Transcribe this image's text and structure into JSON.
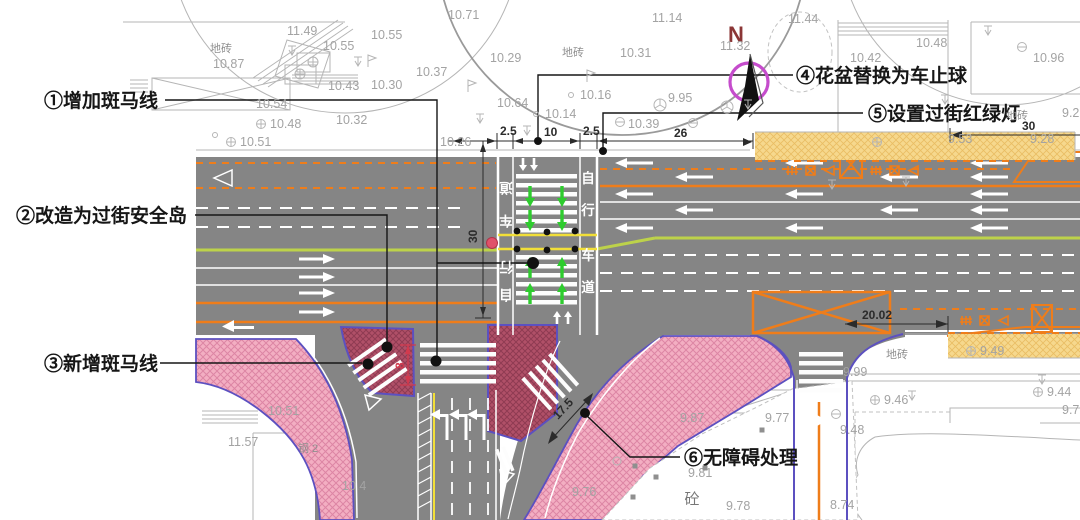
{
  "annotations": {
    "a1": {
      "label": "①增加斑马线"
    },
    "a2": {
      "label": "②改造为过街安全岛"
    },
    "a3": {
      "label": "③新增斑马线"
    },
    "a4": {
      "label": "④花盆替换为车止球"
    },
    "a5": {
      "label": "⑤设置过街红绿灯"
    },
    "a6": {
      "label": "⑥无障碍处理"
    }
  },
  "compass": {
    "north": "N"
  },
  "dimensions": {
    "bike_w_left": "2.5",
    "crossing_w": "10",
    "bike_w_right": "2.5",
    "road_e": "26",
    "road_ne": "30",
    "crossing_len": "30",
    "gap": "20.02",
    "slip_cross": "17.5",
    "south_cross": "8"
  },
  "bike_lane_text": "自行车道",
  "lane_labels": {
    "bike_left": [
      "道",
      "车",
      "行",
      "自"
    ],
    "bike_right": [
      "自",
      "行",
      "车",
      "道"
    ]
  },
  "surface_labels": {
    "paving": "地砖",
    "concrete": "砼",
    "steel": "钢 2"
  },
  "elevations": [
    {
      "v": "11.49",
      "x": 287,
      "y": 35
    },
    {
      "v": "10.55",
      "x": 323,
      "y": 50
    },
    {
      "v": "10.55",
      "x": 371,
      "y": 39
    },
    {
      "v": "10.87",
      "x": 213,
      "y": 68
    },
    {
      "v": "10.54",
      "x": 256,
      "y": 108
    },
    {
      "v": "10.48",
      "x": 270,
      "y": 128,
      "m": "oplus"
    },
    {
      "v": "10.51",
      "x": 240,
      "y": 146,
      "m": "oplus"
    },
    {
      "v": "10.43",
      "x": 328,
      "y": 90
    },
    {
      "v": "10.30",
      "x": 371,
      "y": 89
    },
    {
      "v": "10.32",
      "x": 336,
      "y": 124
    },
    {
      "v": "10.37",
      "x": 416,
      "y": 76
    },
    {
      "v": "10.71",
      "x": 448,
      "y": 19
    },
    {
      "v": "10.29",
      "x": 490,
      "y": 62
    },
    {
      "v": "10.64",
      "x": 497,
      "y": 107
    },
    {
      "v": "10.14",
      "x": 545,
      "y": 118,
      "m": "circ"
    },
    {
      "v": "10.16",
      "x": 580,
      "y": 99,
      "m": "circ"
    },
    {
      "v": "9.95",
      "x": 668,
      "y": 102
    },
    {
      "v": "10.39",
      "x": 628,
      "y": 128
    },
    {
      "v": "10.31",
      "x": 620,
      "y": 57
    },
    {
      "v": "11.14",
      "x": 652,
      "y": 22
    },
    {
      "v": "10.26",
      "x": 440,
      "y": 146
    },
    {
      "v": "11.32",
      "x": 720,
      "y": 50
    },
    {
      "v": "11.44",
      "x": 788,
      "y": 23
    },
    {
      "v": "10.42",
      "x": 850,
      "y": 62
    },
    {
      "v": "10.48",
      "x": 916,
      "y": 47
    },
    {
      "v": "10.96",
      "x": 1033,
      "y": 62
    },
    {
      "v": "9.53",
      "x": 948,
      "y": 143
    },
    {
      "v": "9.28",
      "x": 1030,
      "y": 143
    },
    {
      "v": "9.2",
      "x": 1062,
      "y": 117
    },
    {
      "v": "10.51",
      "x": 268,
      "y": 415
    },
    {
      "v": "11.57",
      "x": 228,
      "y": 446
    },
    {
      "v": "10.4",
      "x": 342,
      "y": 490
    },
    {
      "v": "9.99",
      "x": 843,
      "y": 376
    },
    {
      "v": "9.49",
      "x": 980,
      "y": 355,
      "m": "oplus"
    },
    {
      "v": "9.46",
      "x": 884,
      "y": 404,
      "m": "oplus"
    },
    {
      "v": "9.44",
      "x": 1047,
      "y": 396,
      "m": "oplus"
    },
    {
      "v": "9.7",
      "x": 1062,
      "y": 414
    },
    {
      "v": "9.87",
      "x": 680,
      "y": 422
    },
    {
      "v": "9.77",
      "x": 765,
      "y": 422
    },
    {
      "v": "9.48",
      "x": 840,
      "y": 434
    },
    {
      "v": "9.81",
      "x": 688,
      "y": 477
    },
    {
      "v": "9.76",
      "x": 572,
      "y": 496
    },
    {
      "v": "9.78",
      "x": 726,
      "y": 510
    },
    {
      "v": "8.74",
      "x": 830,
      "y": 509
    }
  ],
  "symbols": [
    {
      "t": "tick",
      "x": 292,
      "y": 46
    },
    {
      "t": "tick",
      "x": 358,
      "y": 57
    },
    {
      "t": "tick",
      "x": 480,
      "y": 114
    },
    {
      "t": "tick",
      "x": 527,
      "y": 126
    },
    {
      "t": "tick",
      "x": 748,
      "y": 100
    },
    {
      "t": "tick",
      "x": 832,
      "y": 180
    },
    {
      "t": "tick",
      "x": 945,
      "y": 95
    },
    {
      "t": "tick",
      "x": 988,
      "y": 26
    },
    {
      "t": "tick",
      "x": 906,
      "y": 177
    },
    {
      "t": "tick",
      "x": 912,
      "y": 391
    },
    {
      "t": "tick",
      "x": 1042,
      "y": 375
    },
    {
      "t": "oplus",
      "x": 877,
      "y": 142
    },
    {
      "t": "ominus",
      "x": 620,
      "y": 122
    },
    {
      "t": "ominus",
      "x": 693,
      "y": 123
    },
    {
      "t": "ominus",
      "x": 1022,
      "y": 47
    },
    {
      "t": "ominus",
      "x": 836,
      "y": 414
    },
    {
      "t": "tree",
      "x": 660,
      "y": 105
    },
    {
      "t": "tree",
      "x": 727,
      "y": 107
    },
    {
      "t": "flag",
      "x": 368,
      "y": 55
    },
    {
      "t": "flag",
      "x": 587,
      "y": 70
    },
    {
      "t": "flag",
      "x": 468,
      "y": 80
    },
    {
      "t": "circ",
      "x": 215,
      "y": 135
    }
  ],
  "plot_squares": [
    [
      635,
      466
    ],
    [
      656,
      477
    ],
    [
      633,
      497
    ],
    [
      705,
      468
    ],
    [
      762,
      430
    ]
  ],
  "colors": {
    "road": "#858585",
    "orange": "#ef7d1a",
    "chartreuse": "#bdd24a",
    "yellow": "#f2df38",
    "green": "#2ecc2e",
    "pink_bg": "#f3aec2",
    "pink_hatch": "#dd85a4",
    "maroon_bg": "#b05068",
    "maroon_hatch": "#8f3b52",
    "curb": "#5c50c0",
    "ystrip_bg": "#f6d88d",
    "ystrip_hatch": "#e9bd63",
    "survey": "#b5b5b5",
    "surveytext": "#a3a3a3",
    "compass_ring": "#c54ccc",
    "reddim": "#d23a4e",
    "north_letter": "#8b3636"
  }
}
